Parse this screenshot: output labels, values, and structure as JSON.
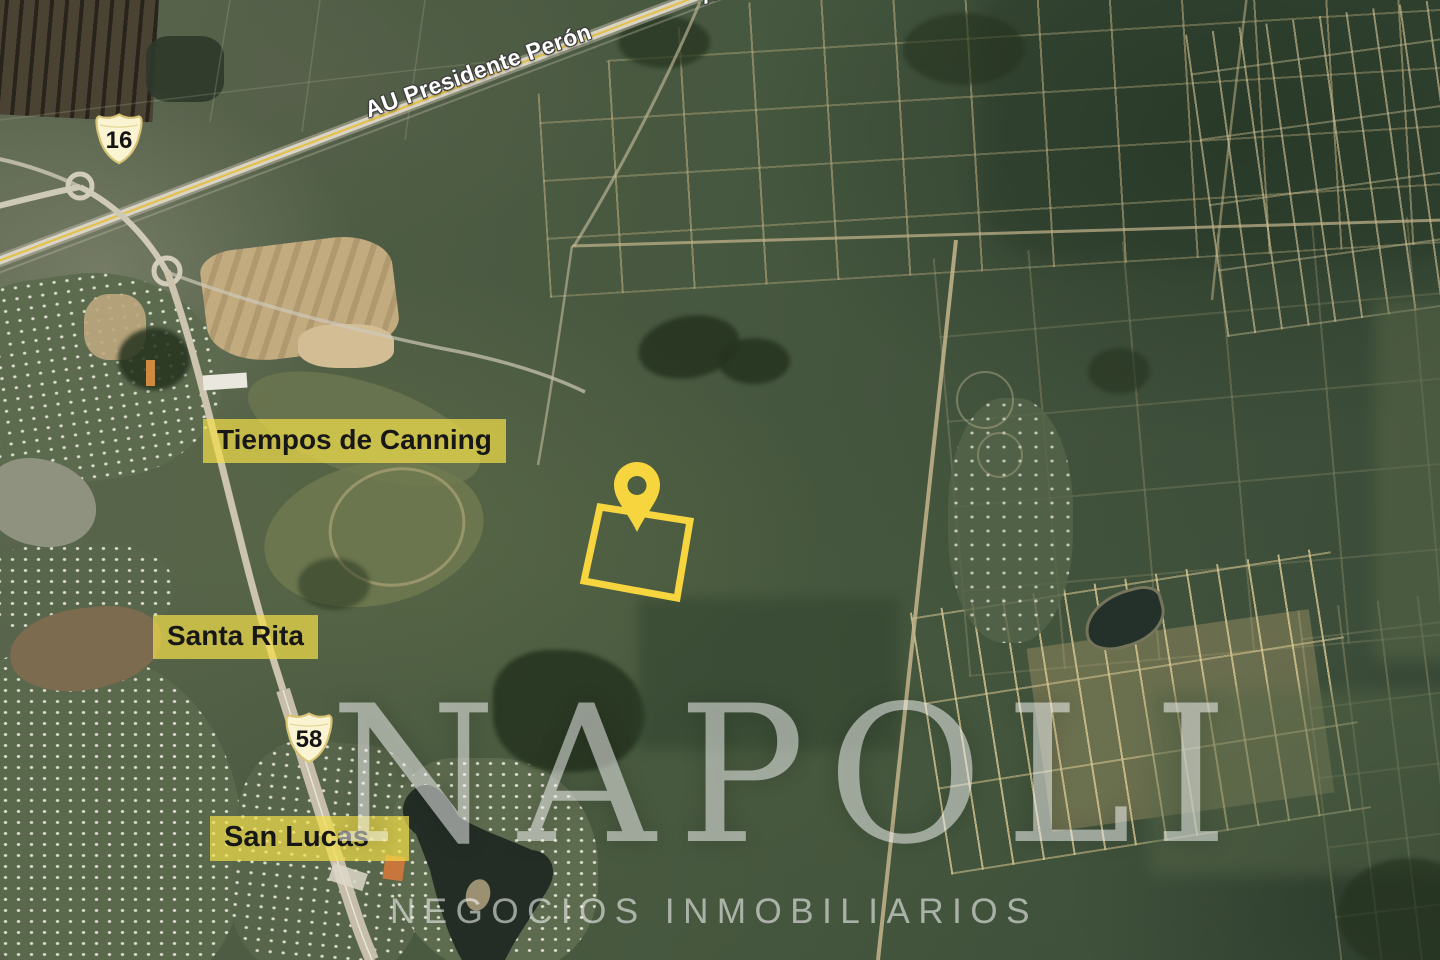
{
  "map": {
    "highway_label": "AU Presidente Perón",
    "highway_label_top": "AU Presidente Perón",
    "shields": [
      {
        "number": "16"
      },
      {
        "number": "58"
      }
    ],
    "places": [
      {
        "text": "Tiempos de Canning"
      },
      {
        "text": "Santa Rita"
      },
      {
        "text": "San Lucas"
      }
    ],
    "marker": {
      "type": "location-pin",
      "color": "#F7D53E"
    },
    "parcel_outline_color": "#F7D53E"
  },
  "watermark": {
    "brand": "NAPOLI",
    "tagline": "NEGOCIOS INMOBILIARIOS"
  },
  "colors": {
    "accent_yellow": "#F7D53E",
    "label_highlight": "#F3E04A",
    "shield_fill": "#FBF4D3",
    "shield_border": "#D8C474"
  }
}
